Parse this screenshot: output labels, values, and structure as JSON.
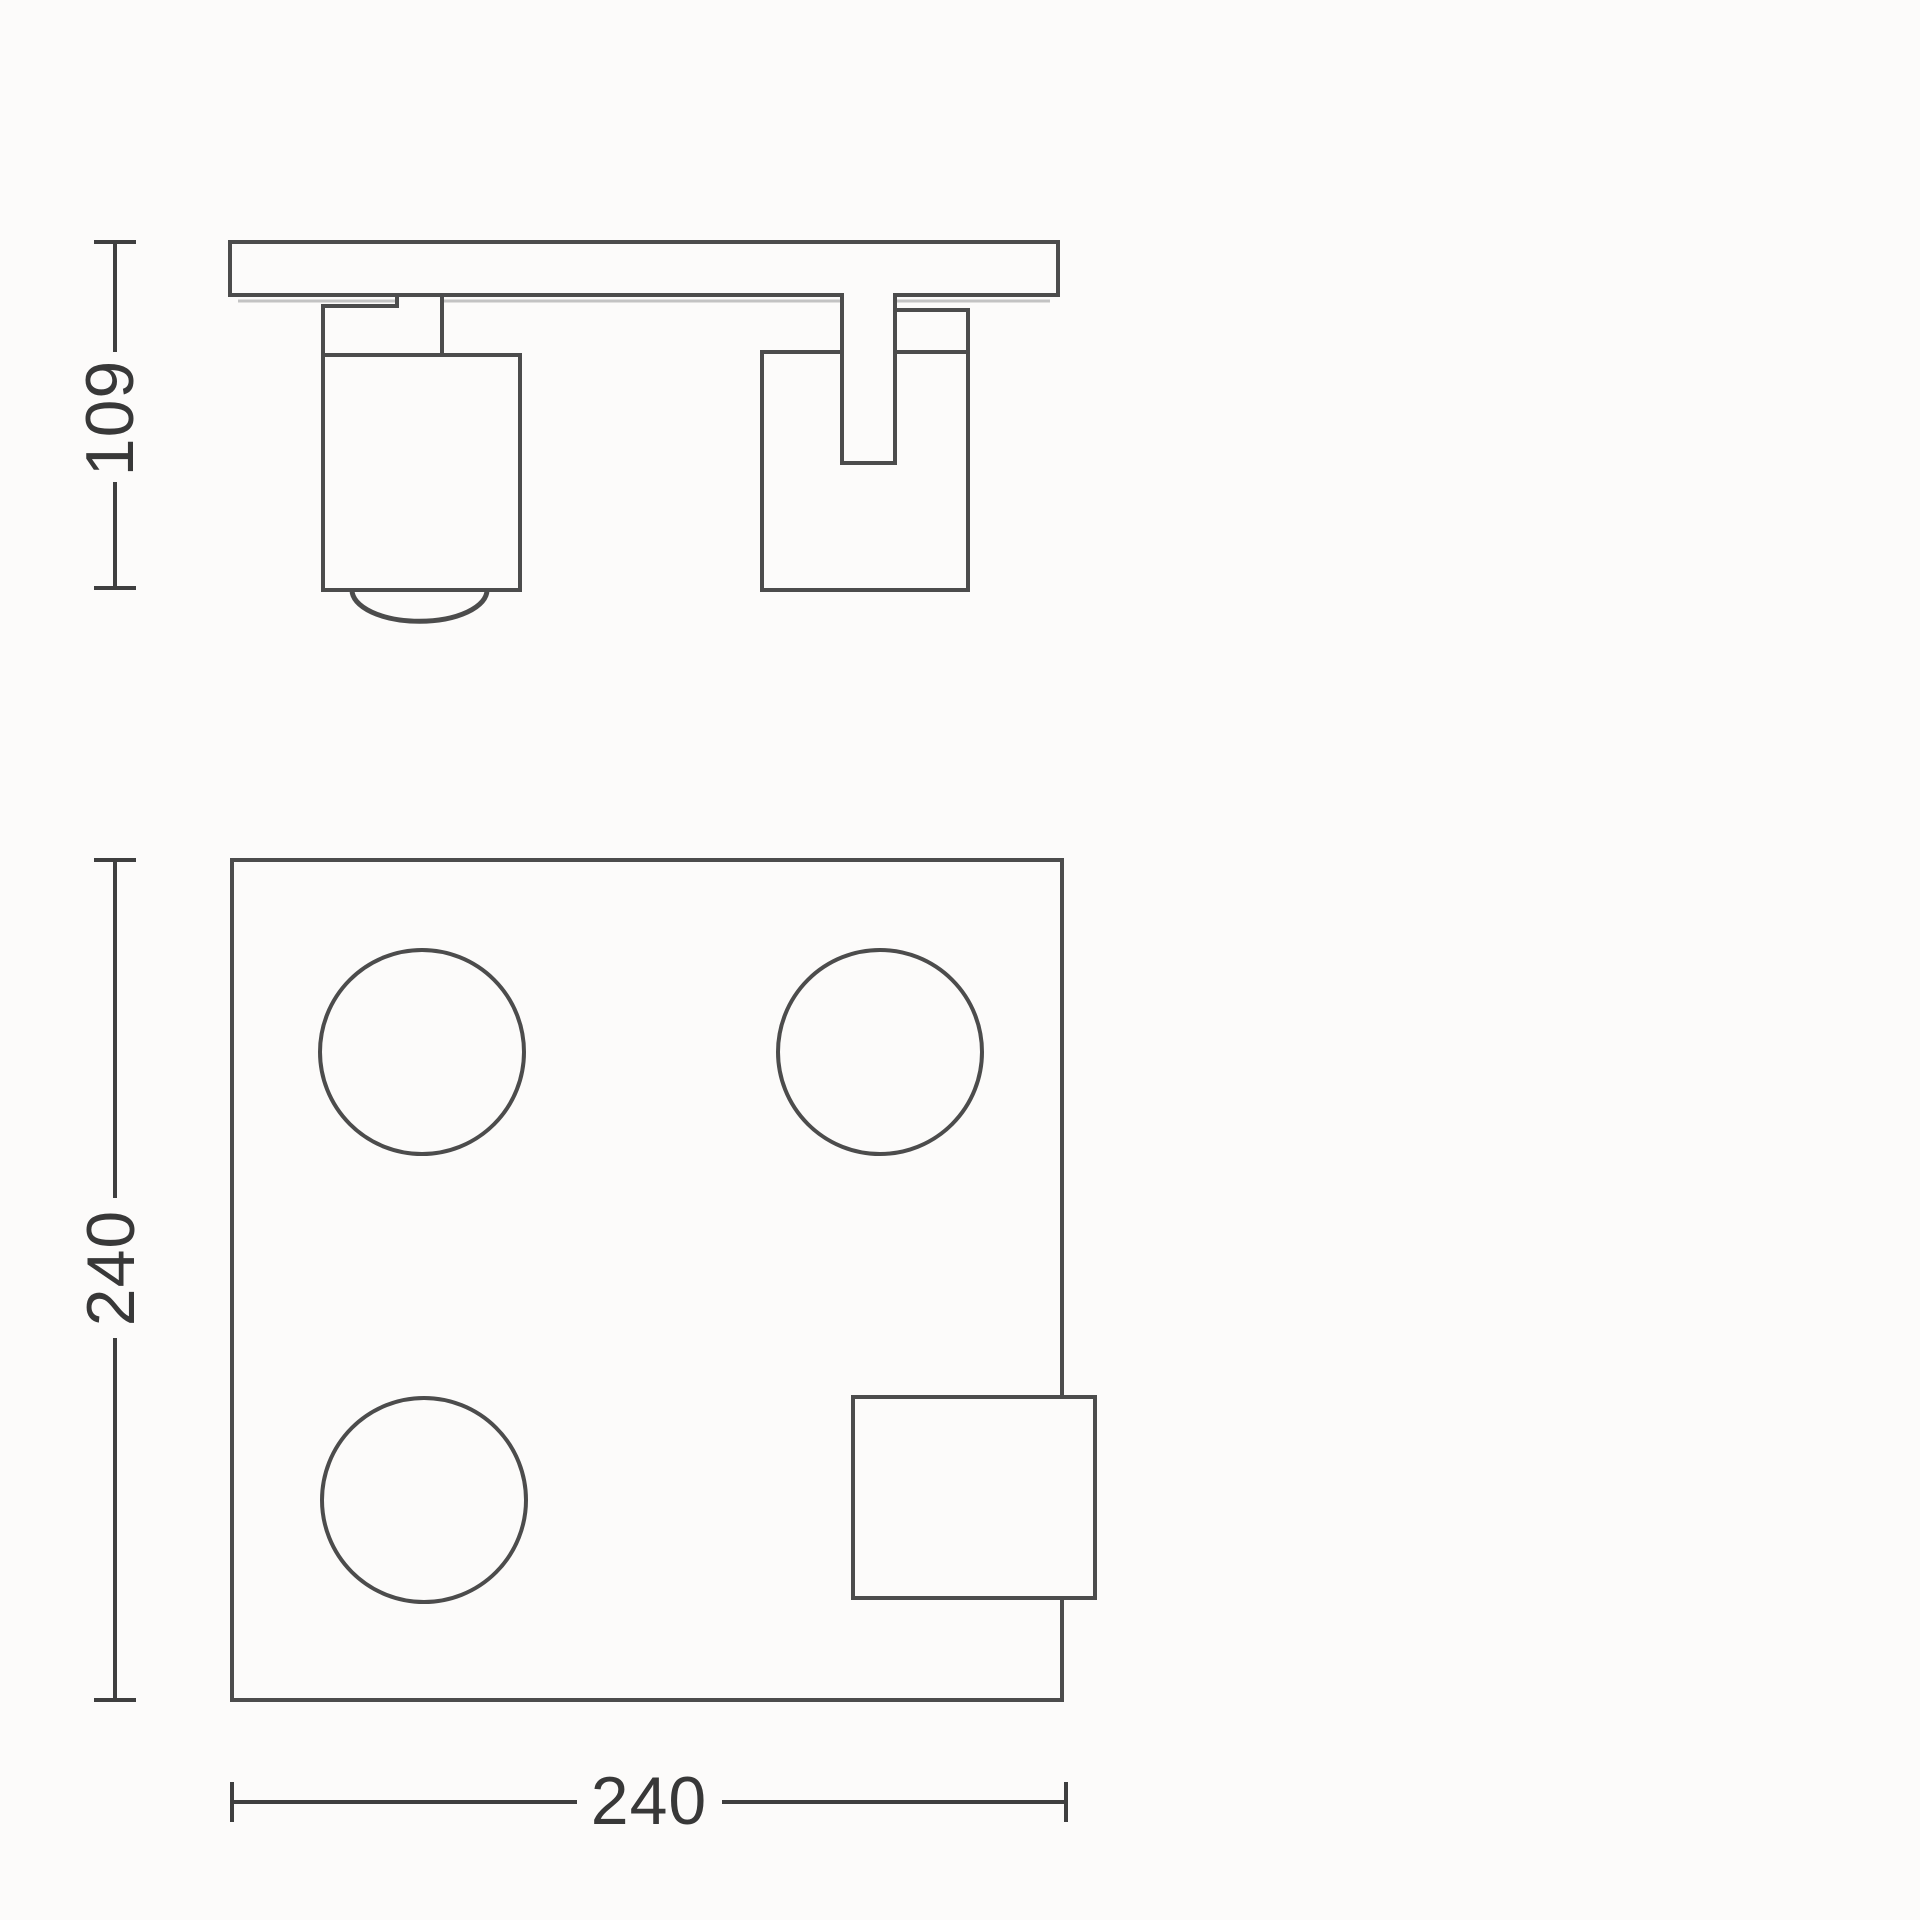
{
  "drawing": {
    "kind": "technical-dimension-diagram",
    "views": {
      "side_view": "spotlight side elevation with mounting plate and two spot heads",
      "plan_view": "square ceiling plate with three spot openings and connection box"
    },
    "labels": {
      "side_height": "109",
      "plan_height": "240",
      "plan_width": "240"
    },
    "colors": {
      "line": "#4c4c4c",
      "dimension": "#3f3f3f",
      "text": "#383838",
      "shadow": "#c3c3c3",
      "background": "#fcfbfa"
    }
  }
}
